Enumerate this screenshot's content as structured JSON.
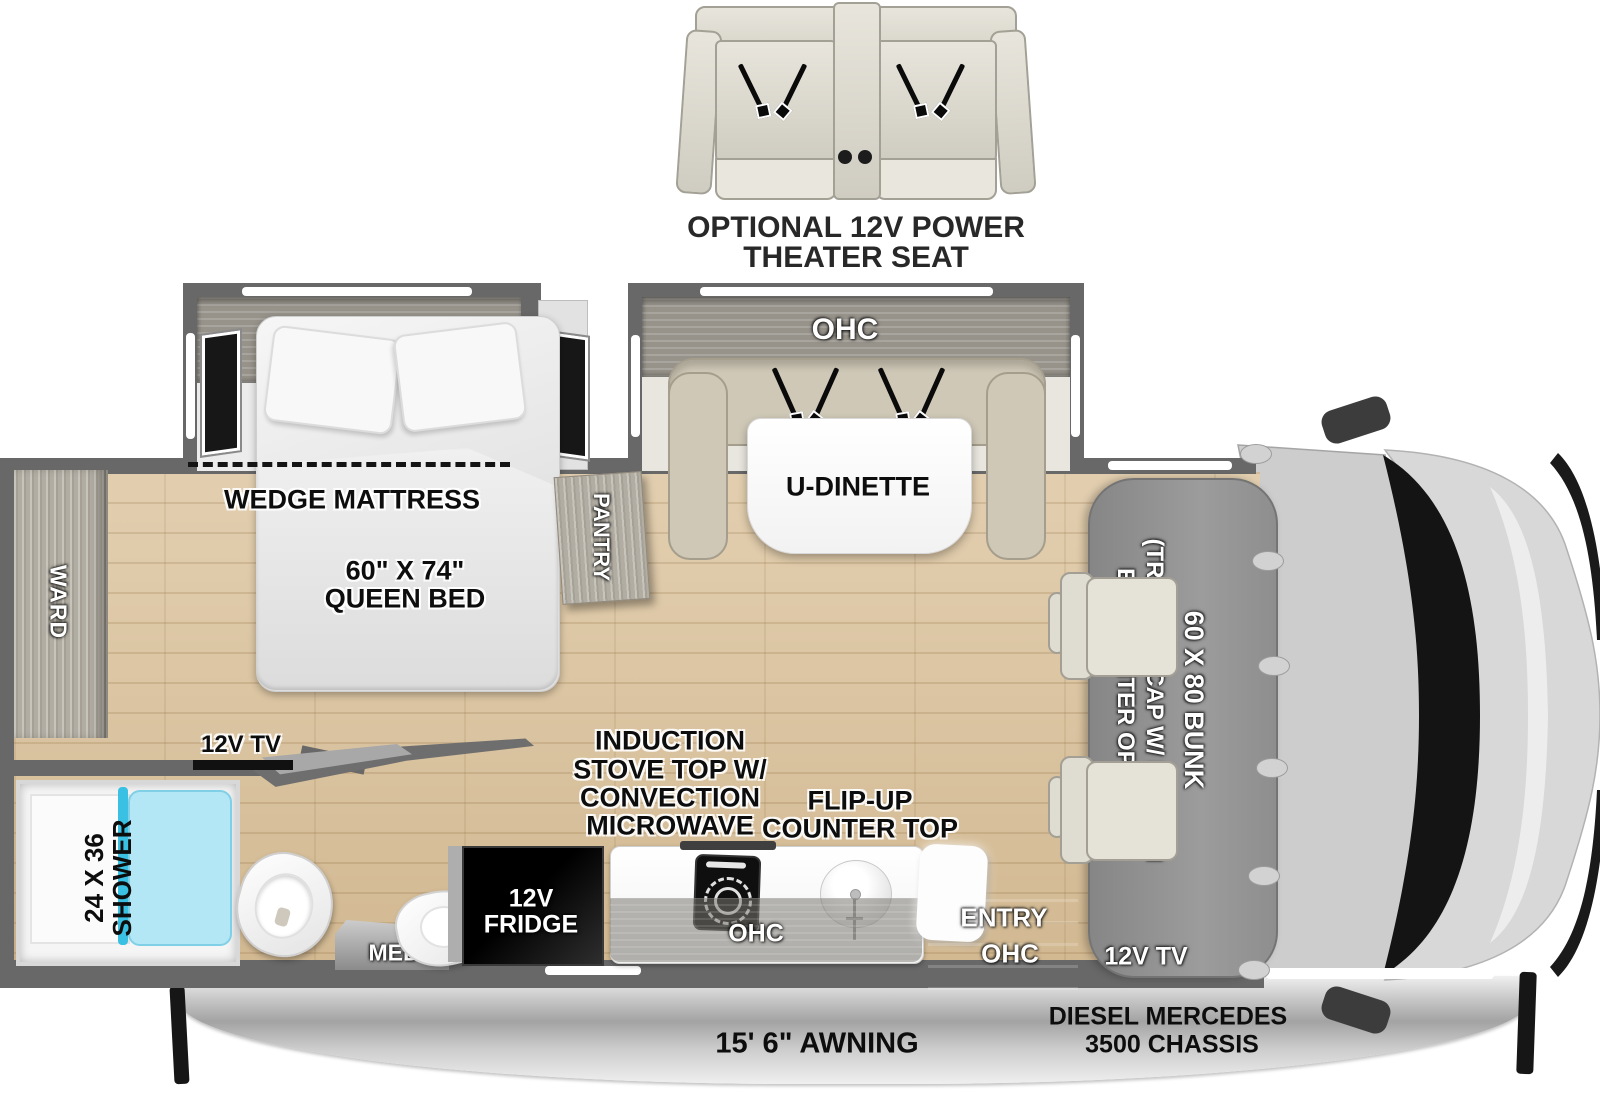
{
  "optional_theater_seat": {
    "line1": "OPTIONAL 12V POWER",
    "line2": "THEATER SEAT"
  },
  "bedroom": {
    "ohc": "OHC",
    "wedge_mattress": "WEDGE MATTRESS",
    "queen_bed_line1": "60\" X 74\"",
    "queen_bed_line2": "QUEEN BED",
    "ward": "WARD",
    "pantry": "PANTRY",
    "tv": "12V TV"
  },
  "dinette": {
    "ohc": "OHC",
    "label": "U-DINETTE"
  },
  "bathroom": {
    "shower_size": "24 X 36",
    "shower": "SHOWER",
    "med": "MED"
  },
  "kitchen": {
    "appliance_line1": "INDUCTION",
    "appliance_line2": "STOVE TOP W/",
    "appliance_line3": "CONVECTION",
    "appliance_line4": "MICROWAVE",
    "flip_line1": "FLIP-UP",
    "flip_line2": "COUNTER TOP",
    "fridge_line1": "12V",
    "fridge_line2": "FRIDGE",
    "ohc": "OHC"
  },
  "entry": {
    "label": "ENTRY",
    "ohc": "OHC"
  },
  "cab_area": {
    "bunk": "60 X 80 BUNK",
    "trekker_line1": "(TREKKER CAP W/ BUILT-IN",
    "trekker_line2": "ENT. CENTER OPTION)",
    "tv": "12V TV"
  },
  "chassis": {
    "awning": "15' 6\" AWNING",
    "line1": "DIESEL MERCEDES",
    "line2": "3500 CHASSIS"
  },
  "colors": {
    "wall": "#686868",
    "floor_wood": "#dcc49e",
    "shower_accent": "#3ac0e2",
    "bunk_gray": "#909090",
    "bench_beige": "#cfc8b7",
    "awning_silver": "#c9c9c9",
    "windshield": "#141414"
  }
}
